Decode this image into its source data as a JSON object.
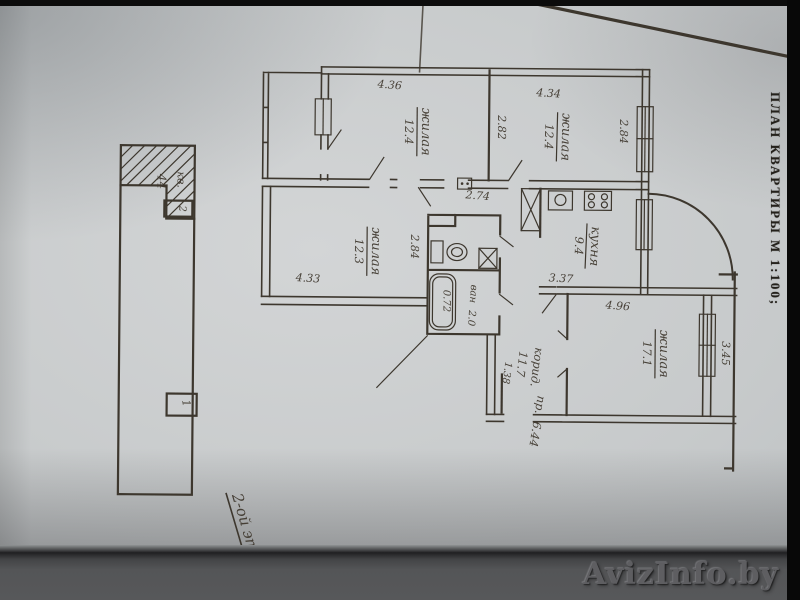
{
  "photo": {
    "side_caption": "ПЛАН КВАРТИРЫ М 1:100;",
    "floor_note": "2-ой эт.",
    "watermark": "AvizInfo.by"
  },
  "plan": {
    "rooms": {
      "room_a": {
        "name": "жилая",
        "area": "12.4"
      },
      "room_b": {
        "name": "жилая",
        "area": "12.4"
      },
      "room_c": {
        "name": "жилая",
        "area": "12.3"
      },
      "kitchen": {
        "name": "кухня",
        "area": "9.4"
      },
      "room_d": {
        "name": "жилая",
        "area": "17.1"
      },
      "bath": {
        "name": "ван",
        "area": "2.0"
      },
      "corridor": {
        "name": "корид.",
        "area": "11.7"
      },
      "hallway": {
        "name": "пр.",
        "area": "6.44"
      }
    },
    "dims": {
      "room_a_width": "4.36",
      "room_b_width": "4.34",
      "room_b_left": "2.82",
      "room_b_depth": "2.84",
      "hall_width": "2.74",
      "room_c_width": "4.33",
      "room_c_depth": "2.84",
      "kitchen_width": "3.37",
      "room_d_width": "4.96",
      "room_d_depth": "3.45",
      "tub": "0.72",
      "corridor_width": "1.38"
    },
    "markers": {
      "flat": "кв.",
      "flat_no": "44",
      "box_top": "2",
      "box_bottom": "1"
    }
  }
}
